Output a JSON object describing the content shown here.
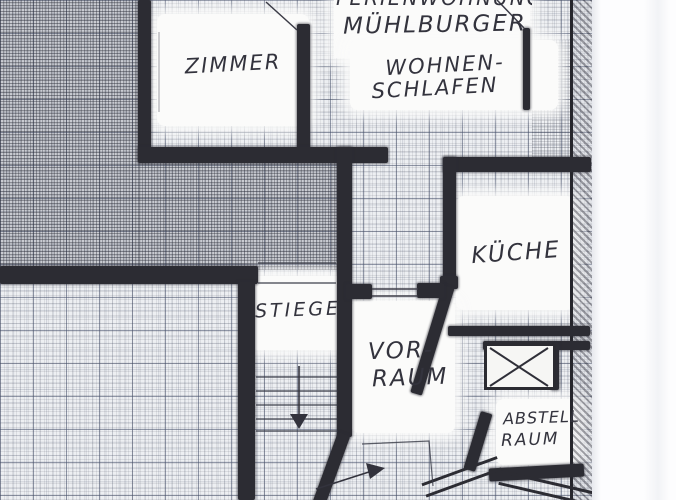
{
  "floorplan": {
    "title": {
      "line1": "FERIENWOHNUNG",
      "line2": "MÜHLBURGER"
    },
    "rooms": {
      "zimmer": {
        "label": "ZIMMER"
      },
      "wohnen": {
        "line1": "WOHNEN-",
        "line2": "SCHLAFEN"
      },
      "kueche": {
        "label": "KÜCHE"
      },
      "stiege": {
        "label": "STIEGE"
      },
      "vorraum": {
        "line1": "VOR-",
        "line2": "RAUM"
      },
      "abstell": {
        "line1": "ABSTELL",
        "line2": "RAUM"
      }
    },
    "icons": {
      "stairs_down_arrow": "▼",
      "entrance_arrow": "➤",
      "shaft_symbol": "x-crossed-box"
    },
    "colors": {
      "pencil": "#2c2c33",
      "ink": "#33333d",
      "paper": "#edeff2",
      "grid": "#48526c",
      "margin": "#fdfdfe"
    }
  }
}
